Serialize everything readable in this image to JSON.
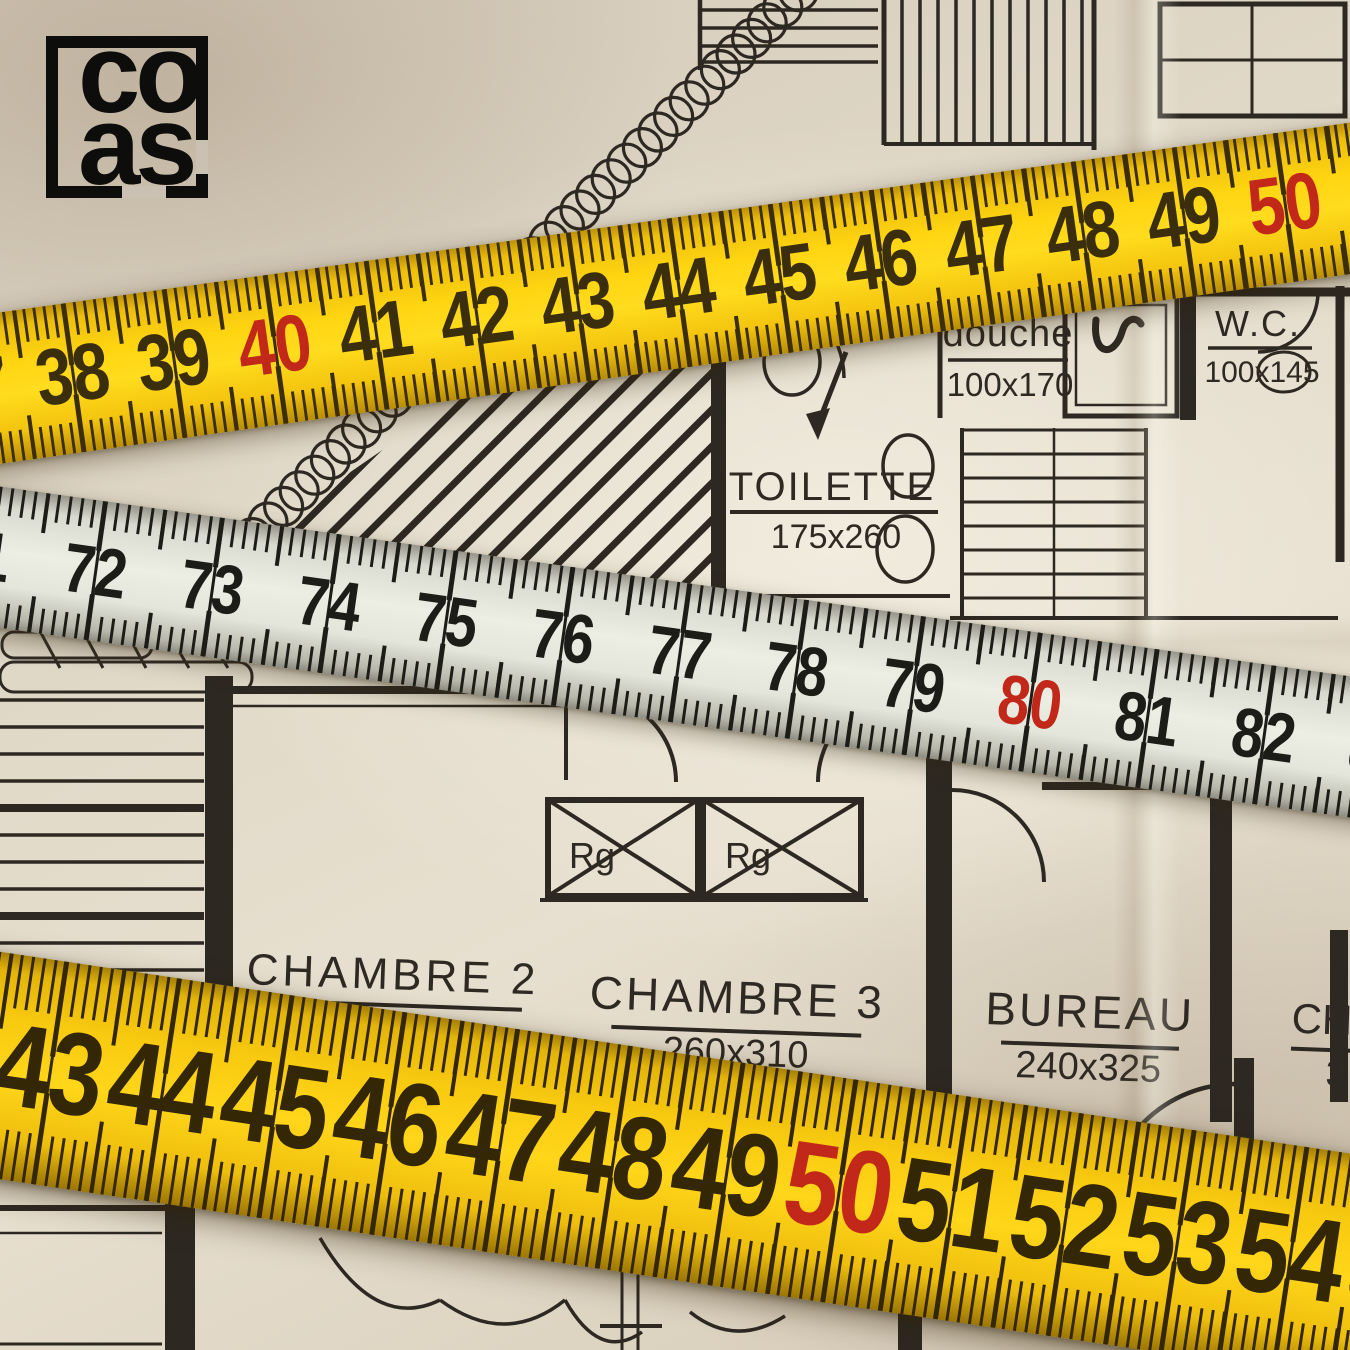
{
  "logo": {
    "line1": "co",
    "line2": "as"
  },
  "colors": {
    "paper": "#ddd2c0",
    "plan_ink": "#2d2822",
    "red_mark": "#c2281a",
    "tape_yellow": "#f8ca10",
    "tape_white": "#eceee4",
    "tick_yellow": "#3a2e0c",
    "tick_white": "#1d1d17"
  },
  "plan": {
    "rooms": {
      "douche": {
        "name": "douche",
        "dims": "100x170"
      },
      "wc": {
        "name": "W.C.",
        "dims": "100x145"
      },
      "toilette": {
        "name": "TOILETTE",
        "dims": "175x260"
      },
      "chambre2": {
        "name": "CHAMBRE 2"
      },
      "chambre3": {
        "name": "CHAMBRE 3",
        "dims": "260x310"
      },
      "bureau": {
        "name": "BUREAU",
        "dims": "240x325"
      },
      "chambre4": {
        "name": "CH",
        "dims": "3"
      },
      "rangement1": {
        "abbr": "Rg"
      },
      "rangement2": {
        "abbr": "Rg"
      }
    }
  },
  "tapes": {
    "top": {
      "first": 37,
      "last": 53,
      "red_numbers": [
        40,
        50
      ],
      "unit": 102,
      "offset": 93,
      "tick": "#3a2e0c"
    },
    "middle": {
      "first": 71,
      "last": 84,
      "red_numbers": [
        80
      ],
      "unit": 118,
      "offset": 59,
      "tick": "#1d1d17"
    },
    "bottom": {
      "first": 42,
      "last": 55,
      "red_numbers": [
        50
      ],
      "unit": 114,
      "offset": 17,
      "tick": "#332706"
    }
  }
}
